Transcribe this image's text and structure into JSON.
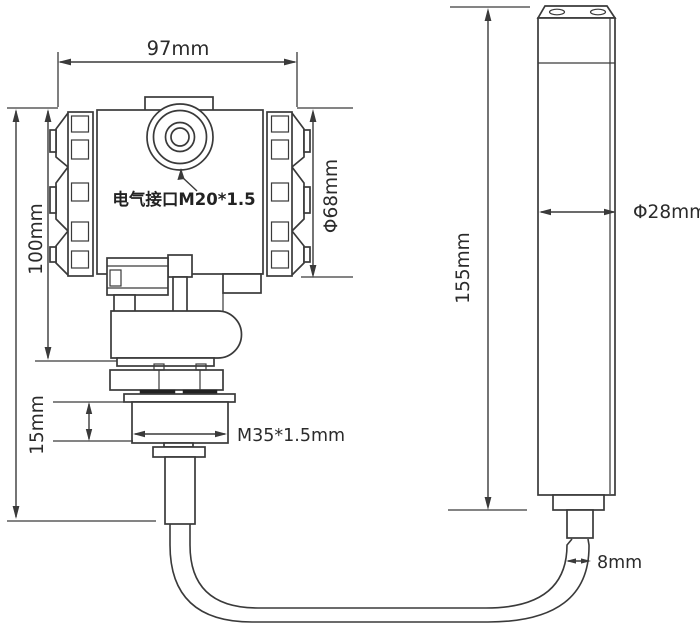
{
  "drawing": {
    "kind": "engineering-dimension-drawing",
    "background_color": "#ffffff",
    "line_color": "#3a3a3a",
    "text_color": "#2b2b2b"
  },
  "labels": {
    "housing_width": "97mm",
    "housing_height": "100mm",
    "housing_diameter": "Φ68mm",
    "electrical_port": "电气接口M20*1.5",
    "thread_spec": "M35*1.5mm",
    "thread_length": "15mm",
    "probe_length": "155mm",
    "probe_diameter": "Φ28mm",
    "cable_diameter": "8mm"
  }
}
